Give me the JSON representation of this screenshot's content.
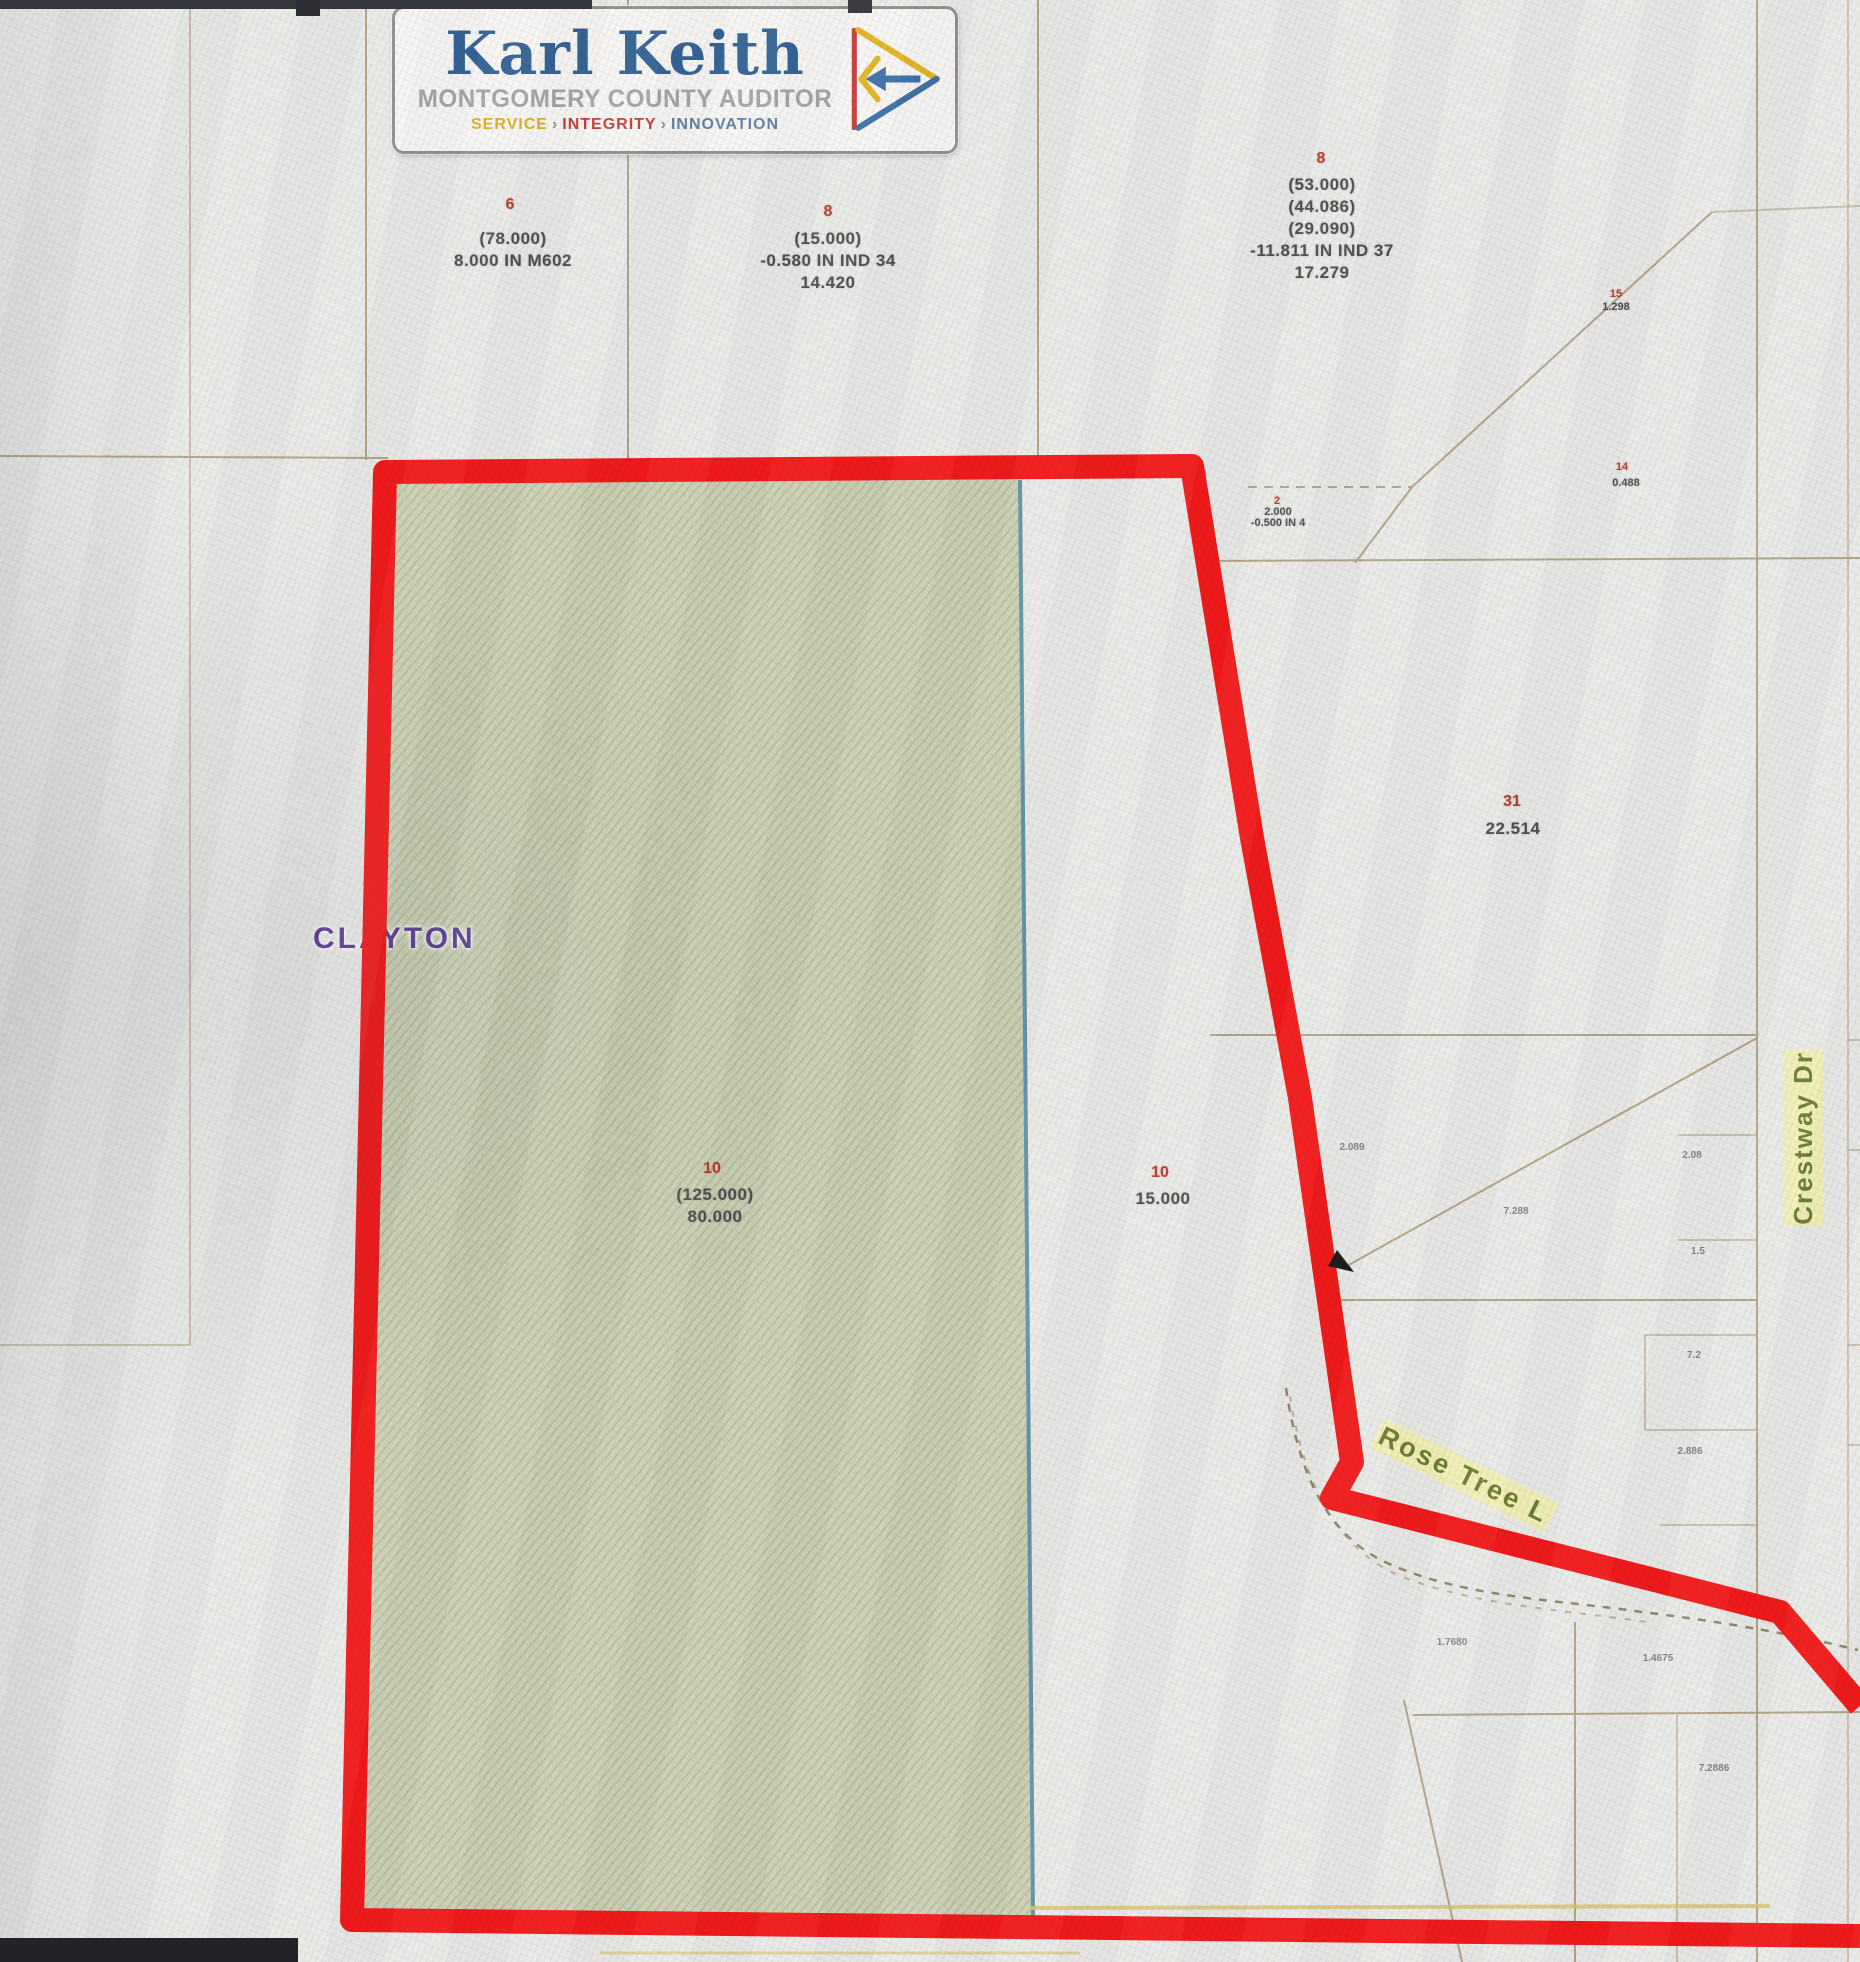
{
  "logo": {
    "name": "Karl Keith",
    "subtitle": "MONTGOMERY COUNTY AUDITOR",
    "tagline": {
      "service": "SERVICE",
      "integrity": "INTEGRITY",
      "innovation": "INNOVATION",
      "separator": "›"
    }
  },
  "map": {
    "municipality": "CLAYTON",
    "streets": {
      "crestway": "Crestway Dr",
      "rose_tree": "Rose Tree L"
    },
    "parcels": [
      {
        "id": "6",
        "lines": [
          "(78.000)",
          "8.000 IN M602"
        ]
      },
      {
        "id": "8",
        "lines": [
          "(15.000)",
          "-0.580 IN IND 34",
          "14.420"
        ]
      },
      {
        "id": "8",
        "lines": [
          "(53.000)",
          "(44.086)",
          "(29.090)",
          "-11.811 IN IND 37",
          "17.279"
        ]
      },
      {
        "id": "31",
        "lines": [
          "22.514"
        ]
      },
      {
        "id": "10",
        "lines": [
          "(125.000)",
          "80.000"
        ]
      },
      {
        "id": "10",
        "lines": [
          "15.000"
        ]
      },
      {
        "id": "14",
        "lines": [
          "0.488"
        ]
      },
      {
        "id": "15",
        "lines": [
          "1.298"
        ]
      },
      {
        "id": "2",
        "lines": [
          "2.000",
          "-0.500 IN 4"
        ]
      }
    ],
    "small_labels": [
      "2.089",
      "7.288",
      "2.08",
      "1.5",
      "7.2",
      "2.886",
      "1.7680",
      "1.4675",
      "7.2886"
    ],
    "colors": {
      "boundary_red": "#f21313",
      "parcel_green": "#ccd1b5",
      "green_edge_blue": "#5e93a8",
      "parcel_line": "#a08b63",
      "parcel_id_red": "#b2382c",
      "municipality_purple": "#5a3d91",
      "street_olive": "#6b7a2e",
      "street_halo": "#f3f0a6"
    }
  }
}
